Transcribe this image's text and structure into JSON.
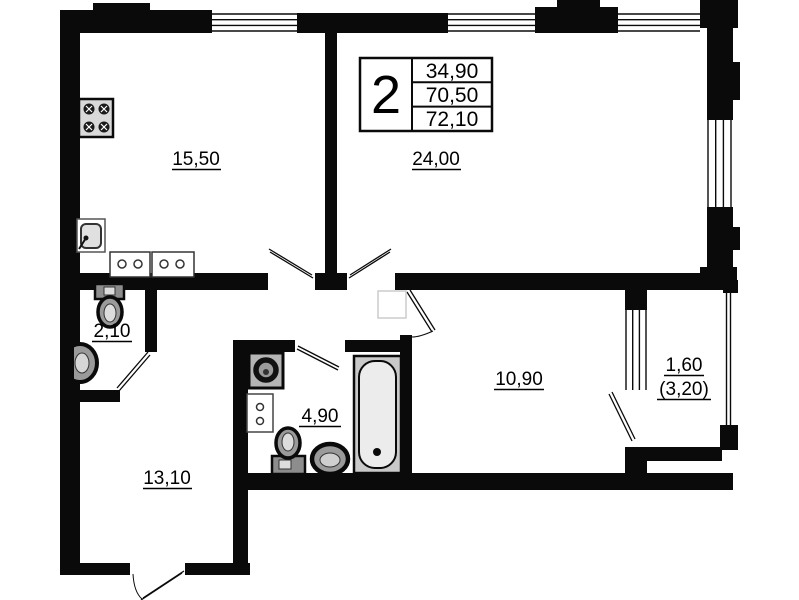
{
  "document": {
    "type": "apartment-floor-plan"
  },
  "colors": {
    "wall": "#0a0a0a",
    "paper": "#ffffff",
    "fixture_gray": "#bfbfbf"
  },
  "title_block": {
    "room_count": "2",
    "rows": [
      "34,90",
      "70,50",
      "72,10"
    ]
  },
  "rooms": [
    {
      "id": "kitchen",
      "area_label": "15,50"
    },
    {
      "id": "living-room",
      "area_label": "24,00"
    },
    {
      "id": "wc",
      "area_label": "2,10"
    },
    {
      "id": "hallway",
      "area_label": "13,10"
    },
    {
      "id": "bathroom",
      "area_label": "4,90"
    },
    {
      "id": "bedroom",
      "area_label": "10,90"
    },
    {
      "id": "balcony",
      "area_label": "1,60",
      "area_label_secondary": "(3,20)"
    }
  ],
  "fixtures": [
    "stove",
    "kitchen-sink",
    "kitchen-cabinets",
    "wc-toilet",
    "wc-corner-sink",
    "washing-machine",
    "bathroom-cabinet",
    "bathroom-toilet",
    "bathroom-round-sink",
    "bathtub"
  ]
}
